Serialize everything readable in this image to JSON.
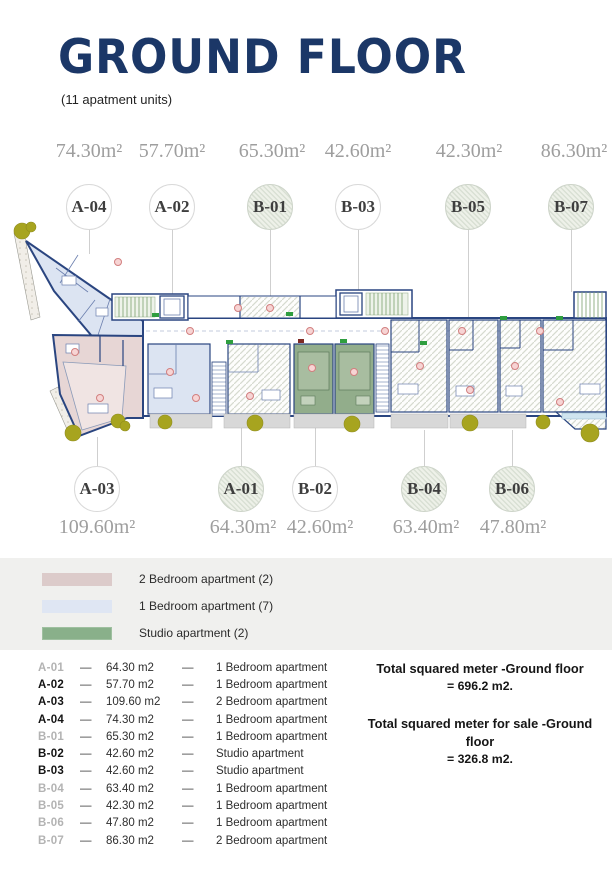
{
  "header": {
    "title": "GROUND FLOOR",
    "subtitle": "(11 apatment units)"
  },
  "plan": {
    "top_units": [
      {
        "id": "A-04",
        "area": "74.30m²",
        "hatched": false
      },
      {
        "id": "A-02",
        "area": "57.70m²",
        "hatched": false
      },
      {
        "id": "B-01",
        "area": "65.30m²",
        "hatched": true
      },
      {
        "id": "B-03",
        "area": "42.60m²",
        "hatched": false
      },
      {
        "id": "B-05",
        "area": "42.30m²",
        "hatched": true
      },
      {
        "id": "B-07",
        "area": "86.30m²",
        "hatched": true
      }
    ],
    "bottom_units": [
      {
        "id": "A-03",
        "area": "109.60m²",
        "hatched": false
      },
      {
        "id": "A-01",
        "area": "64.30m²",
        "hatched": true
      },
      {
        "id": "B-02",
        "area": "42.60m²",
        "hatched": false
      },
      {
        "id": "B-04",
        "area": "63.40m²",
        "hatched": true
      },
      {
        "id": "B-06",
        "area": "47.80m²",
        "hatched": true
      }
    ]
  },
  "legend": {
    "items": [
      {
        "label": "2 Bedroom apartment (2)",
        "color": "#dccbca"
      },
      {
        "label": "1 Bedroom apartment (7)",
        "color": "#dfe6f3"
      },
      {
        "label": "Studio apartment (2)",
        "color": "#89b08a"
      }
    ]
  },
  "table": {
    "separator": "—",
    "rows": [
      {
        "code": "A-01",
        "area": "64.30 m2",
        "type": "1 Bedroom apartment",
        "muted": true
      },
      {
        "code": "A-02",
        "area": "57.70 m2",
        "type": "1 Bedroom apartment",
        "muted": false
      },
      {
        "code": "A-03",
        "area": "109.60 m2",
        "type": "2 Bedroom apartment",
        "muted": false
      },
      {
        "code": "A-04",
        "area": "74.30 m2",
        "type": "1 Bedroom apartment",
        "muted": false
      },
      {
        "code": "B-01",
        "area": "65.30 m2",
        "type": "1 Bedroom apartment",
        "muted": true
      },
      {
        "code": "B-02",
        "area": "42.60 m2",
        "type": "Studio apartment",
        "muted": false
      },
      {
        "code": "B-03",
        "area": "42.60 m2",
        "type": "Studio apartment",
        "muted": false
      },
      {
        "code": "B-04",
        "area": "63.40 m2",
        "type": "1 Bedroom apartment",
        "muted": true
      },
      {
        "code": "B-05",
        "area": "42.30 m2",
        "type": "1 Bedroom apartment",
        "muted": true
      },
      {
        "code": "B-06",
        "area": "47.80 m2",
        "type": "1 Bedroom apartment",
        "muted": true
      },
      {
        "code": "B-07",
        "area": "86.30 m2",
        "type": "2 Bedroom apartment",
        "muted": true
      }
    ]
  },
  "totals": {
    "title1": "Total squared meter -Ground floor",
    "value1": "= 696.2 m2.",
    "title2": "Total squared meter for sale -Ground floor",
    "value2": "= 326.8 m2."
  },
  "colors": {
    "title_navy": "#1b3767",
    "wall_navy": "#2a4580",
    "one_bedroom_fill": "#dce4f2",
    "two_bedroom_fill": "#e7d6d5",
    "studio_fill": "#92ad8b",
    "tree_olive": "#a7a41f"
  }
}
